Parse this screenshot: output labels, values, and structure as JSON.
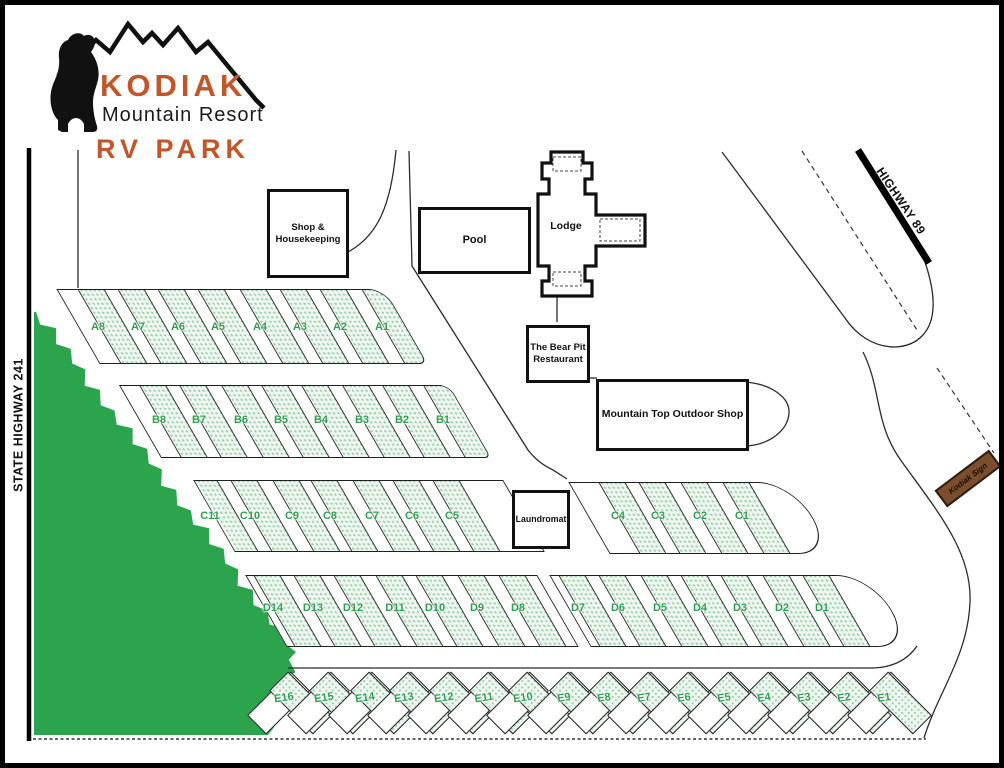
{
  "logo": {
    "title": "KODIAK",
    "subtitle": "Mountain Resort",
    "park": "RV PARK"
  },
  "roads": {
    "state_highway_label": "STATE HIGHWAY 241",
    "highway89_label": "HIGHWAY 89",
    "sign_label": "Kodiak Sign"
  },
  "buildings": {
    "shop": {
      "lines": [
        "Shop &",
        "Housekeeping"
      ]
    },
    "pool": {
      "label": "Pool"
    },
    "lodge": {
      "label": "Lodge"
    },
    "bear_pit": {
      "lines": [
        "The Bear Pit",
        "Restaurant"
      ]
    },
    "mountain_top": {
      "label": "Mountain Top Outdoor Shop"
    },
    "laundromat": {
      "label": "Laundromat"
    }
  },
  "colors": {
    "brand_orange": "#c0562a",
    "spot_green": "#2f9e4e",
    "forest_green": "#2ca34d",
    "sign_brown": "#7d4e2d"
  },
  "rv_rows": [
    {
      "id": "A",
      "band": "A",
      "label_y": 327,
      "spots": [
        {
          "label": "A8",
          "x": 98
        },
        {
          "label": "A7",
          "x": 138
        },
        {
          "label": "A6",
          "x": 178
        },
        {
          "label": "A5",
          "x": 218
        },
        {
          "label": "A4",
          "x": 260
        },
        {
          "label": "A3",
          "x": 300
        },
        {
          "label": "A2",
          "x": 340
        },
        {
          "label": "A1",
          "x": 382
        }
      ]
    },
    {
      "id": "B",
      "band": "B",
      "label_y": 420,
      "spots": [
        {
          "label": "B8",
          "x": 159
        },
        {
          "label": "B7",
          "x": 199
        },
        {
          "label": "B6",
          "x": 241
        },
        {
          "label": "B5",
          "x": 281
        },
        {
          "label": "B4",
          "x": 321
        },
        {
          "label": "B3",
          "x": 362
        },
        {
          "label": "B2",
          "x": 402
        },
        {
          "label": "B1",
          "x": 443
        }
      ]
    },
    {
      "id": "C-west",
      "band": "CL",
      "label_y": 516,
      "spots": [
        {
          "label": "C11",
          "x": 210
        },
        {
          "label": "C10",
          "x": 250
        },
        {
          "label": "C9",
          "x": 292
        },
        {
          "label": "C8",
          "x": 330
        },
        {
          "label": "C7",
          "x": 372
        },
        {
          "label": "C6",
          "x": 412
        },
        {
          "label": "C5",
          "x": 452
        }
      ]
    },
    {
      "id": "C-east",
      "band": "CR",
      "label_y": 516,
      "spots": [
        {
          "label": "C4",
          "x": 618
        },
        {
          "label": "C3",
          "x": 658
        },
        {
          "label": "C2",
          "x": 700
        },
        {
          "label": "C1",
          "x": 742
        }
      ]
    },
    {
      "id": "D-west",
      "band": "DL",
      "label_y": 608,
      "spots": [
        {
          "label": "D14",
          "x": 273
        },
        {
          "label": "D13",
          "x": 313
        },
        {
          "label": "D12",
          "x": 353
        },
        {
          "label": "D11",
          "x": 395
        },
        {
          "label": "D10",
          "x": 435
        },
        {
          "label": "D9",
          "x": 477
        },
        {
          "label": "D8",
          "x": 518
        }
      ]
    },
    {
      "id": "D-east",
      "band": "DR",
      "label_y": 608,
      "spots": [
        {
          "label": "D7",
          "x": 578
        },
        {
          "label": "D6",
          "x": 618
        },
        {
          "label": "D5",
          "x": 660
        },
        {
          "label": "D4",
          "x": 700
        },
        {
          "label": "D3",
          "x": 740
        },
        {
          "label": "D2",
          "x": 782
        },
        {
          "label": "D1",
          "x": 822
        }
      ]
    },
    {
      "id": "E",
      "band": "E",
      "type": "herringbone",
      "label_y": 699,
      "spots": [
        {
          "label": "E16",
          "x": 280
        },
        {
          "label": "E15",
          "x": 320
        },
        {
          "label": "E14",
          "x": 361
        },
        {
          "label": "E13",
          "x": 400
        },
        {
          "label": "E12",
          "x": 440
        },
        {
          "label": "E11",
          "x": 480
        },
        {
          "label": "E10",
          "x": 519
        },
        {
          "label": "E9",
          "x": 560
        },
        {
          "label": "E8",
          "x": 600
        },
        {
          "label": "E7",
          "x": 640
        },
        {
          "label": "E6",
          "x": 680
        },
        {
          "label": "E5",
          "x": 720
        },
        {
          "label": "E4",
          "x": 760
        },
        {
          "label": "E3",
          "x": 800
        },
        {
          "label": "E2",
          "x": 840
        },
        {
          "label": "E1",
          "x": 880
        }
      ]
    }
  ]
}
